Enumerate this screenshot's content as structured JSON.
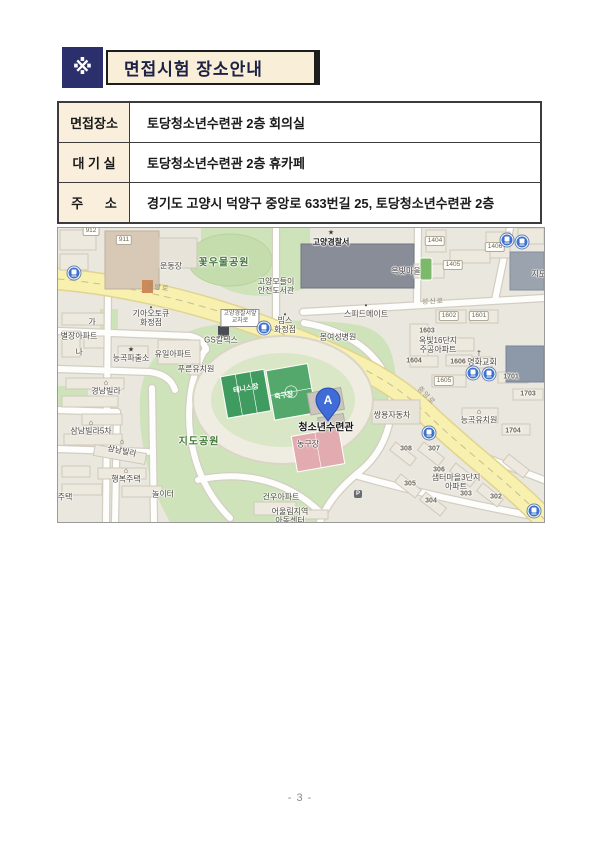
{
  "header": {
    "bullet": "※",
    "title": "면접시험 장소안내"
  },
  "table": {
    "rows": [
      {
        "label": "면접장소",
        "value": "토당청소년수련관 2층 회의실"
      },
      {
        "label": "대 기 실",
        "value": "토당청소년수련관 2층 휴카페"
      },
      {
        "label": "주      소",
        "value": "경기도 고양시 덕양구 중앙로 633번길 25, 토당청소년수련관 2층"
      }
    ]
  },
  "map": {
    "marker": {
      "letter": "A"
    },
    "colors": {
      "road_yellow": "#f8f0ae",
      "park_green": "#cfe3ba",
      "court_green": "#4a9e63",
      "court_pink": "#e2abb0",
      "marker_blue": "#3f6cd6",
      "bus_blue": "#3d72cc",
      "police_building_gray": "#888d97"
    },
    "labels": [
      {
        "text": "꽃우물공원",
        "x": 166,
        "y": 35,
        "cls": "park",
        "name": "park-label-kkotumul"
      },
      {
        "text": "운동장",
        "x": 113,
        "y": 38
      },
      {
        "text": "고양경찰서",
        "x": 273,
        "y": 14,
        "cls": "dark",
        "name": "police-station-label"
      },
      {
        "text": "★",
        "x": 273,
        "y": 5,
        "cls": "icon",
        "name": "police-icon"
      },
      {
        "text": "고양모들이\n안전도서관",
        "x": 218,
        "y": 58
      },
      {
        "text": "옥빛마을",
        "x": 348,
        "y": 43
      },
      {
        "text": "지도",
        "x": 481,
        "y": 46
      },
      {
        "text": "성신로",
        "x": 375,
        "y": 74,
        "cls": "road",
        "rot": -2,
        "name": "road-label-seongsinro"
      },
      {
        "text": "중앙로",
        "x": 100,
        "y": 60,
        "cls": "road",
        "rot": 8,
        "name": "road-label-jungangro"
      },
      {
        "text": "중앙로",
        "x": 368,
        "y": 168,
        "cls": "road",
        "rot": 45,
        "name": "road-label-jungangro"
      },
      {
        "text": "▪",
        "x": 308,
        "y": 78,
        "cls": "icon"
      },
      {
        "text": "스피드메이트",
        "x": 308,
        "y": 86
      },
      {
        "text": "봄여성병원",
        "x": 280,
        "y": 109
      },
      {
        "text": "고양경찰서앞\n교차로",
        "x": 182,
        "y": 90,
        "cls": "boxed",
        "name": "intersection-sign"
      },
      {
        "text": "▪",
        "x": 227,
        "y": 87,
        "cls": "icon"
      },
      {
        "text": "빕스\n화정점",
        "x": 227,
        "y": 97
      },
      {
        "text": "▪",
        "x": 93,
        "y": 80,
        "cls": "icon"
      },
      {
        "text": "기아오토큐\n화정점",
        "x": 93,
        "y": 90
      },
      {
        "text": "GS칼텍스",
        "x": 163,
        "y": 112
      },
      {
        "text": "가",
        "x": 34,
        "y": 94
      },
      {
        "text": "별장아파트",
        "x": 21,
        "y": 108
      },
      {
        "text": "나",
        "x": 21,
        "y": 124
      },
      {
        "text": "★",
        "x": 73,
        "y": 122,
        "cls": "icon"
      },
      {
        "text": "능곡파출소",
        "x": 73,
        "y": 130
      },
      {
        "text": "유일아파트",
        "x": 115,
        "y": 126
      },
      {
        "text": "푸른유치원",
        "x": 138,
        "y": 141
      },
      {
        "text": "⌂",
        "x": 48,
        "y": 155,
        "cls": "icon"
      },
      {
        "text": "경남빌라",
        "x": 48,
        "y": 163
      },
      {
        "text": "⌂",
        "x": 33,
        "y": 195,
        "cls": "icon"
      },
      {
        "text": "삼남빌라5차",
        "x": 33,
        "y": 203
      },
      {
        "text": "⌂",
        "x": 64,
        "y": 214,
        "cls": "icon"
      },
      {
        "text": "삼남빌라",
        "x": 64,
        "y": 223,
        "rot": 12
      },
      {
        "text": "⌂",
        "x": 68,
        "y": 243,
        "cls": "icon"
      },
      {
        "text": "행복주택",
        "x": 68,
        "y": 251
      },
      {
        "text": "주택",
        "x": 7,
        "y": 269
      },
      {
        "text": "놀이터",
        "x": 105,
        "y": 266
      },
      {
        "text": "지도공원",
        "x": 141,
        "y": 214,
        "cls": "park",
        "name": "park-label-jido"
      },
      {
        "text": "테니스장",
        "x": 188,
        "y": 161,
        "cls": "white",
        "rot": -10,
        "name": "tennis-court-label"
      },
      {
        "text": "축구장",
        "x": 226,
        "y": 168,
        "cls": "white",
        "rot": -10,
        "name": "soccer-field-label"
      },
      {
        "text": "농구장",
        "x": 250,
        "y": 216,
        "name": "basketball-court-label"
      },
      {
        "text": "청소년수련관",
        "x": 268,
        "y": 200,
        "cls": "marker",
        "name": "youth-center-label"
      },
      {
        "text": "쌍용자동차",
        "x": 334,
        "y": 187
      },
      {
        "text": "건우아파트",
        "x": 223,
        "y": 269
      },
      {
        "text": "어울림지역\n아동센터",
        "x": 232,
        "y": 288
      },
      {
        "text": "옥빛16단지\n주공아파트",
        "x": 380,
        "y": 117
      },
      {
        "text": "†",
        "x": 421,
        "y": 126,
        "cls": "icon",
        "name": "church-icon"
      },
      {
        "text": "영화교회",
        "x": 424,
        "y": 134
      },
      {
        "text": "⌂",
        "x": 421,
        "y": 184,
        "cls": "icon"
      },
      {
        "text": "능곡유치원",
        "x": 421,
        "y": 192
      },
      {
        "text": "샘터마을3단지\n아파트",
        "x": 398,
        "y": 254
      },
      {
        "text": "P",
        "x": 300,
        "y": 266,
        "cls": "pbox",
        "name": "parking-icon"
      },
      {
        "text": "1603",
        "x": 369,
        "y": 103,
        "cls": "num"
      },
      {
        "text": "1604",
        "x": 356,
        "y": 133,
        "cls": "num"
      },
      {
        "text": "1606",
        "x": 400,
        "y": 134,
        "cls": "num"
      },
      {
        "text": "1701",
        "x": 453,
        "y": 149,
        "cls": "num"
      },
      {
        "text": "1703",
        "x": 470,
        "y": 166,
        "cls": "num"
      },
      {
        "text": "1704",
        "x": 455,
        "y": 203,
        "cls": "num"
      },
      {
        "text": "308",
        "x": 348,
        "y": 221,
        "cls": "num"
      },
      {
        "text": "307",
        "x": 376,
        "y": 221,
        "cls": "num"
      },
      {
        "text": "306",
        "x": 381,
        "y": 242,
        "cls": "num"
      },
      {
        "text": "305",
        "x": 352,
        "y": 256,
        "cls": "num"
      },
      {
        "text": "304",
        "x": 373,
        "y": 273,
        "cls": "num"
      },
      {
        "text": "303",
        "x": 408,
        "y": 266,
        "cls": "num"
      },
      {
        "text": "302",
        "x": 438,
        "y": 269,
        "cls": "num"
      }
    ],
    "plates": [
      {
        "text": "912",
        "x": 33,
        "y": 3
      },
      {
        "text": "911",
        "x": 66,
        "y": 12
      },
      {
        "text": "1404",
        "x": 377,
        "y": 13
      },
      {
        "text": "1405",
        "x": 395,
        "y": 37
      },
      {
        "text": "1406",
        "x": 437,
        "y": 19
      },
      {
        "text": "1602",
        "x": 391,
        "y": 88
      },
      {
        "text": "1601",
        "x": 421,
        "y": 88
      },
      {
        "text": "1605",
        "x": 386,
        "y": 153
      }
    ],
    "bus_stops": [
      {
        "x": 16,
        "y": 45
      },
      {
        "x": 206,
        "y": 100
      },
      {
        "x": 449,
        "y": 12
      },
      {
        "x": 464,
        "y": 14
      },
      {
        "x": 415,
        "y": 145
      },
      {
        "x": 431,
        "y": 146
      },
      {
        "x": 371,
        "y": 205
      },
      {
        "x": 476,
        "y": 283
      }
    ]
  },
  "footer": {
    "page": "- 3 -"
  }
}
